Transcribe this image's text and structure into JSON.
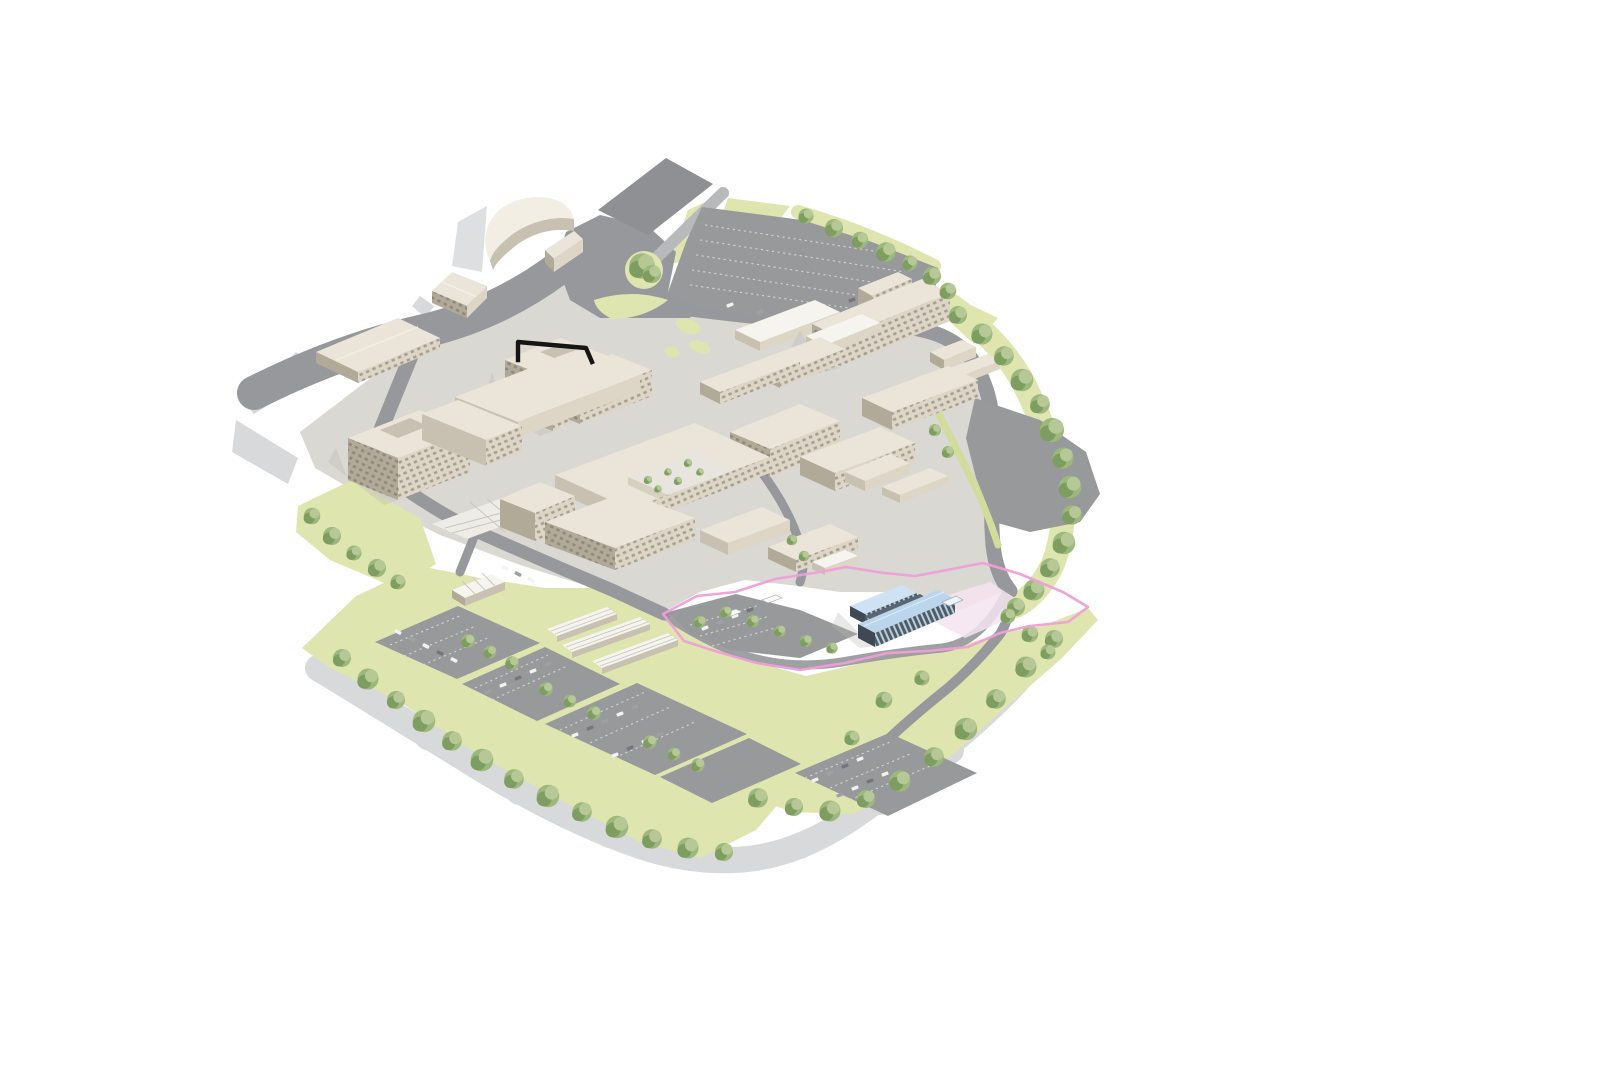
{
  "scene": {
    "type": "isometric-site-plan",
    "description": "Isometric architectural masterplan rendering of a hospital campus: beige building blocks, grey roads and car parks with parked cars, yellow-green landscaping with trees, a pink site boundary line around the development zone, and a proposed building highlighted with a light blue roof. A black outline marks one existing rooftop.",
    "highlights": {
      "proposed_building_roof": "#bad5ec",
      "site_boundary_line": "#ee9fd8",
      "existing_roof_outline_marker": "#151515"
    }
  },
  "palette": {
    "background": "#ffffff",
    "shadow": "#d8d9db",
    "campus_ground": "#dad8d3",
    "road": "#97989b",
    "road_dark": "#8f9093",
    "road_light": "#b8b9bb",
    "pavement": "#c9cacc",
    "parking": "#98999b",
    "green": "#dfe5ae",
    "green_2": "#d2dc9b",
    "tree_light": "#b5c896",
    "tree_mid": "#9cb87d",
    "tree_dark": "#7e9d60",
    "roof": "#eae5d8",
    "roof_light": "#f2eee3",
    "roof_white": "#f6f4ee",
    "wall_light": "#ddd6c6",
    "wall_mid": "#c8c1b1",
    "wall_dark": "#b2aa99",
    "window": "#6b675d",
    "blue_roof": "#bad5ec",
    "blue_roof_light": "#cfe2f3",
    "blue_wall": "#4e5a66",
    "blue_wall_dark": "#3e4954",
    "glass_stripe": "#cfe4f4",
    "pink": "#ee9fd8",
    "pink_pavement": "#f4e4f0",
    "marker": "#151515",
    "bay_line": "#d9dadc",
    "car_white": "#f2f2f2",
    "car_gray": "#9fa0a2",
    "car_dark": "#76777a"
  }
}
